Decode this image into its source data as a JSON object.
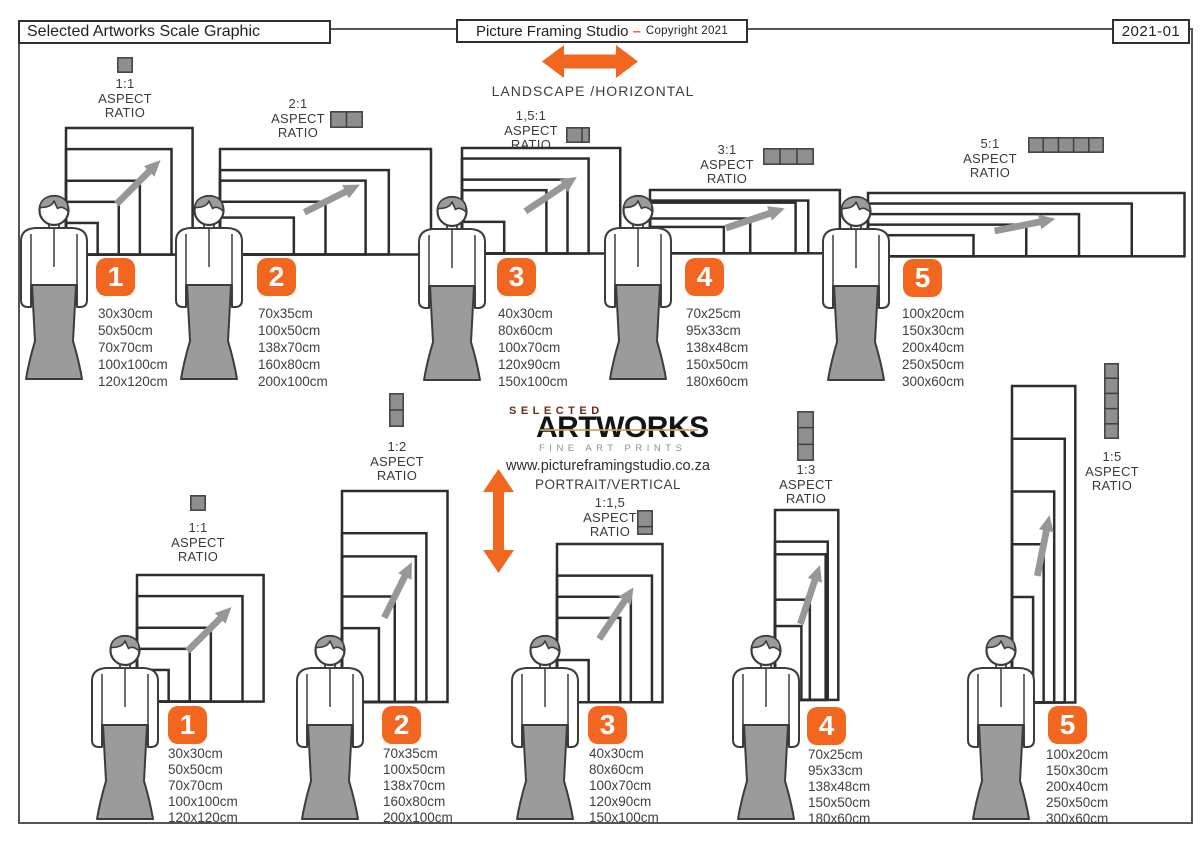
{
  "header": {
    "title": "Selected Artworks Scale Graphic",
    "studio_name": "Picture Framing Studio",
    "studio_dash": "–",
    "copyright": "Copyright 2021",
    "doc_number": "2021-01"
  },
  "center": {
    "landscape_label": "LANDSCAPE /HORIZONTAL",
    "portrait_label": "PORTRAIT/VERTICAL",
    "website": "www.pictureframingstudio.co.za",
    "logo_top": "SELECTED",
    "logo_main": "ARTWORKS",
    "logo_sub": "FINE ART PRINTS"
  },
  "aspect_caption": [
    "ASPECT",
    "RATIO"
  ],
  "colors": {
    "accent_orange": "#F2661F",
    "frame_line": "#2D2D2D",
    "figure_gray": "#9B9B9B",
    "arrow_gray": "#97979A",
    "logo_red": "#6E2A17",
    "logo_gold": "#CAA45F",
    "text_dark": "#3A3A3A"
  },
  "groups": [
    {
      "number": "1",
      "landscape_ratio": "1:1",
      "portrait_ratio": "1:1",
      "cells": 1,
      "sizes": [
        "30x30cm",
        "50x50cm",
        "70x70cm",
        "100x100cm",
        "120x120cm"
      ]
    },
    {
      "number": "2",
      "landscape_ratio": "2:1",
      "portrait_ratio": "1:2",
      "cells": 2,
      "sizes": [
        "70x35cm",
        "100x50cm",
        "138x70cm",
        "160x80cm",
        "200x100cm"
      ]
    },
    {
      "number": "3",
      "landscape_ratio": "1,5:1",
      "portrait_ratio": "1:1,5",
      "cells": 1.5,
      "sizes": [
        "40x30cm",
        "80x60cm",
        "100x70cm",
        "120x90cm",
        "150x100cm"
      ]
    },
    {
      "number": "4",
      "landscape_ratio": "3:1",
      "portrait_ratio": "1:3",
      "cells": 3,
      "sizes": [
        "70x25cm",
        "95x33cm",
        "138x48cm",
        "150x50cm",
        "180x60cm"
      ]
    },
    {
      "number": "5",
      "landscape_ratio": "5:1",
      "portrait_ratio": "1:5",
      "cells": 5,
      "sizes": [
        "100x20cm",
        "150x30cm",
        "200x40cm",
        "250x50cm",
        "300x60cm"
      ]
    }
  ]
}
